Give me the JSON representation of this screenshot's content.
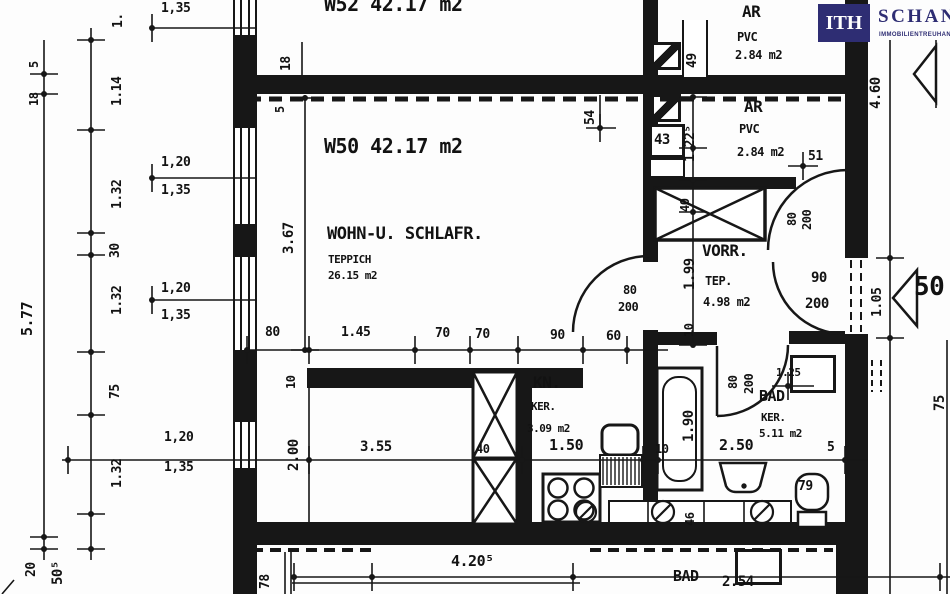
{
  "brand": {
    "logo_box": "ITH",
    "name": "SCHANTL",
    "tagline": "IMMOBILIENTREUHAND",
    "navy": "#2e2d73"
  },
  "plan_summary": {
    "apartments": [
      "W52 42.17 m2",
      "W50 42.17 m2"
    ],
    "rooms_w50": [
      {
        "name": "WOHN-U. SCHLAFR.",
        "floor": "TEPPICH",
        "area": "26.15 m2"
      },
      {
        "name": "VORR.",
        "floor": "TEP.",
        "area": "4.98 m2"
      },
      {
        "name": "KN.",
        "floor": "KER.",
        "area": "3.09 m2"
      },
      {
        "name": "BAD",
        "floor": "KER.",
        "area": "5.11 m2"
      },
      {
        "name": "AR",
        "floor": "PVC",
        "area": "2.84 m2"
      },
      {
        "name": "AR",
        "floor": "PVC",
        "area": "2.84 m2"
      }
    ]
  },
  "labels": [
    {
      "n": "w52-title",
      "t": "W52  42.17 m2",
      "x": 324,
      "y": -6,
      "fs": 20
    },
    {
      "n": "w50-title",
      "t": "W50  42.17 m2",
      "x": 324,
      "y": 136,
      "fs": 20
    },
    {
      "n": "w50-room-name",
      "t": "WOHN-U. SCHLAFR.",
      "x": 327,
      "y": 226,
      "fs": 17
    },
    {
      "n": "w50-floor",
      "t": "TEPPICH",
      "x": 328,
      "y": 254,
      "fs": 11
    },
    {
      "n": "w50-area",
      "t": "26.15 m2",
      "x": 328,
      "y": 270,
      "fs": 11
    },
    {
      "n": "ar1-name",
      "t": "AR",
      "x": 742,
      "y": 4,
      "fs": 16
    },
    {
      "n": "ar1-floor",
      "t": "PVC",
      "x": 737,
      "y": 31,
      "fs": 12
    },
    {
      "n": "ar1-area",
      "t": "2.84 m2",
      "x": 735,
      "y": 49,
      "fs": 12
    },
    {
      "n": "ar2-name",
      "t": "AR",
      "x": 744,
      "y": 99,
      "fs": 16
    },
    {
      "n": "ar2-floor",
      "t": "PVC",
      "x": 739,
      "y": 123,
      "fs": 12
    },
    {
      "n": "ar2-area",
      "t": "2.84 m2",
      "x": 737,
      "y": 146,
      "fs": 12
    },
    {
      "n": "vorr-name",
      "t": "VORR.",
      "x": 702,
      "y": 243,
      "fs": 16
    },
    {
      "n": "vorr-floor",
      "t": "TEP.",
      "x": 705,
      "y": 275,
      "fs": 12
    },
    {
      "n": "vorr-area",
      "t": "4.98 m2",
      "x": 703,
      "y": 296,
      "fs": 12
    },
    {
      "n": "kn-name",
      "t": "KN.",
      "x": 533,
      "y": 375,
      "fs": 16
    },
    {
      "n": "kn-floor",
      "t": "KER.",
      "x": 531,
      "y": 401,
      "fs": 11
    },
    {
      "n": "kn-area",
      "t": "3.09 m2",
      "x": 527,
      "y": 423,
      "fs": 11
    },
    {
      "n": "bad-name",
      "t": "BAD",
      "x": 759,
      "y": 389,
      "fs": 15
    },
    {
      "n": "bad-floor",
      "t": "KER.",
      "x": 761,
      "y": 412,
      "fs": 11
    },
    {
      "n": "bad-area",
      "t": "5.11 m2",
      "x": 759,
      "y": 428,
      "fs": 11
    },
    {
      "n": "nb-bad-name",
      "t": "BAD",
      "x": 673,
      "y": 569,
      "fs": 15
    },
    {
      "n": "nb-bad-dim",
      "t": "2.54",
      "x": 722,
      "y": 575,
      "fs": 14
    },
    {
      "n": "dim-80",
      "t": "80",
      "x": 265,
      "y": 326,
      "fs": 13
    },
    {
      "n": "dim-145",
      "t": "1.45",
      "x": 341,
      "y": 326,
      "fs": 13
    },
    {
      "n": "dim-70a",
      "t": "70",
      "x": 435,
      "y": 327,
      "fs": 13
    },
    {
      "n": "dim-70b",
      "t": "70",
      "x": 475,
      "y": 328,
      "fs": 13
    },
    {
      "n": "dim-90",
      "t": "90",
      "x": 550,
      "y": 329,
      "fs": 13
    },
    {
      "n": "dim-60",
      "t": "60",
      "x": 606,
      "y": 330,
      "fs": 13
    },
    {
      "n": "door-w50-w",
      "t": "80",
      "x": 623,
      "y": 284,
      "fs": 12
    },
    {
      "n": "door-w50-h",
      "t": "200",
      "x": 618,
      "y": 301,
      "fs": 12
    },
    {
      "n": "dim-355",
      "t": "3.55",
      "x": 360,
      "y": 440,
      "fs": 14
    },
    {
      "n": "dim-40",
      "t": "40",
      "x": 476,
      "y": 443,
      "fs": 12
    },
    {
      "n": "dim-150",
      "t": "1.50",
      "x": 549,
      "y": 438,
      "fs": 15
    },
    {
      "n": "dim-10a",
      "t": "10",
      "x": 655,
      "y": 443,
      "fs": 12
    },
    {
      "n": "dim-250",
      "t": "2.50",
      "x": 719,
      "y": 438,
      "fs": 15
    },
    {
      "n": "dim-5a",
      "t": "5",
      "x": 827,
      "y": 441,
      "fs": 13
    },
    {
      "n": "door-entr-w",
      "t": "90",
      "x": 811,
      "y": 271,
      "fs": 14
    },
    {
      "n": "door-entr-h",
      "t": "200",
      "x": 805,
      "y": 297,
      "fs": 14
    },
    {
      "n": "dim-4205",
      "t": "4.20⁵",
      "x": 451,
      "y": 554,
      "fs": 15
    },
    {
      "n": "dim-43",
      "t": "43",
      "x": 654,
      "y": 133,
      "fs": 14
    },
    {
      "n": "dim-51",
      "t": "51",
      "x": 808,
      "y": 150,
      "fs": 13
    },
    {
      "n": "wc-79",
      "t": "79",
      "x": 798,
      "y": 480,
      "fs": 13
    },
    {
      "n": "dim-125",
      "t": "1.25",
      "x": 776,
      "y": 367,
      "fs": 11
    },
    {
      "n": "marker-50",
      "t": "50",
      "x": 914,
      "y": 274,
      "fs": 26
    },
    {
      "n": "win-135a",
      "t": "1,35",
      "x": 161,
      "y": 2,
      "fs": 13
    },
    {
      "n": "win-120a",
      "t": "1,20",
      "x": 161,
      "y": 156,
      "fs": 13
    },
    {
      "n": "win-135b",
      "t": "1,35",
      "x": 161,
      "y": 184,
      "fs": 13
    },
    {
      "n": "win-120b",
      "t": "1,20",
      "x": 161,
      "y": 282,
      "fs": 13
    },
    {
      "n": "win-135c",
      "t": "1,35",
      "x": 161,
      "y": 309,
      "fs": 13
    },
    {
      "n": "win-120c",
      "t": "1,20",
      "x": 164,
      "y": 431,
      "fs": 13
    },
    {
      "n": "win-135d",
      "t": "1,35",
      "x": 164,
      "y": 461,
      "fs": 13
    },
    {
      "n": "dim-577",
      "t": "5.77",
      "x": 20,
      "y": 336,
      "fs": 15,
      "r": 1
    },
    {
      "n": "dim-out5",
      "t": "5",
      "x": 28,
      "y": 68,
      "fs": 12,
      "r": 1
    },
    {
      "n": "dim-out18",
      "t": "18",
      "x": 28,
      "y": 106,
      "fs": 12,
      "r": 1
    },
    {
      "n": "dim-top-part",
      "t": "1.",
      "x": 112,
      "y": 28,
      "fs": 13,
      "r": 1
    },
    {
      "n": "dim-114",
      "t": "1.14",
      "x": 111,
      "y": 106,
      "fs": 13,
      "r": 1
    },
    {
      "n": "dim-132a",
      "t": "1.32",
      "x": 111,
      "y": 209,
      "fs": 13,
      "r": 1
    },
    {
      "n": "dim-30",
      "t": "30",
      "x": 109,
      "y": 258,
      "fs": 13,
      "r": 1
    },
    {
      "n": "dim-132b",
      "t": "1.32",
      "x": 111,
      "y": 315,
      "fs": 13,
      "r": 1
    },
    {
      "n": "dim-75",
      "t": "75",
      "x": 109,
      "y": 399,
      "fs": 13,
      "r": 1
    },
    {
      "n": "dim-132c",
      "t": "1.32",
      "x": 111,
      "y": 488,
      "fs": 13,
      "r": 1
    },
    {
      "n": "dim-20",
      "t": "20",
      "x": 25,
      "y": 577,
      "fs": 13,
      "r": 1
    },
    {
      "n": "dim-505",
      "t": "50⁵",
      "x": 51,
      "y": 585,
      "fs": 14,
      "r": 1
    },
    {
      "n": "dim-int18",
      "t": "18",
      "x": 280,
      "y": 71,
      "fs": 13,
      "r": 1
    },
    {
      "n": "dim-int5",
      "t": "5",
      "x": 274,
      "y": 113,
      "fs": 12,
      "r": 1
    },
    {
      "n": "dim-367",
      "t": "3.67",
      "x": 282,
      "y": 254,
      "fs": 14,
      "r": 1
    },
    {
      "n": "dim-10b",
      "t": "10",
      "x": 285,
      "y": 389,
      "fs": 12,
      "r": 1
    },
    {
      "n": "dim-200v",
      "t": "2.00",
      "x": 287,
      "y": 471,
      "fs": 14,
      "r": 1
    },
    {
      "n": "dim-49",
      "t": "49",
      "x": 686,
      "y": 68,
      "fs": 13,
      "r": 1
    },
    {
      "n": "dim-1225",
      "t": "1.22⁵",
      "x": 684,
      "y": 162,
      "fs": 13,
      "r": 1
    },
    {
      "n": "dim-54",
      "t": "54",
      "x": 584,
      "y": 125,
      "fs": 13,
      "r": 1
    },
    {
      "n": "dim-40w",
      "t": "40",
      "x": 679,
      "y": 212,
      "fs": 12,
      "r": 1
    },
    {
      "n": "dim-199",
      "t": "1.99",
      "x": 683,
      "y": 290,
      "fs": 14,
      "r": 1
    },
    {
      "n": "dim-10c",
      "t": "10",
      "x": 683,
      "y": 337,
      "fs": 12,
      "r": 1
    },
    {
      "n": "door-ar2-w",
      "t": "80",
      "x": 786,
      "y": 226,
      "fs": 12,
      "r": 1
    },
    {
      "n": "door-ar2-h",
      "t": "200",
      "x": 801,
      "y": 230,
      "fs": 12,
      "r": 1
    },
    {
      "n": "door-bad-w",
      "t": "80",
      "x": 727,
      "y": 389,
      "fs": 12,
      "r": 1
    },
    {
      "n": "door-bad-h",
      "t": "200",
      "x": 743,
      "y": 394,
      "fs": 12,
      "r": 1
    },
    {
      "n": "dim-190",
      "t": "1.90",
      "x": 682,
      "y": 442,
      "fs": 14,
      "r": 1
    },
    {
      "n": "dim-46",
      "t": "46",
      "x": 684,
      "y": 526,
      "fs": 12,
      "r": 1
    },
    {
      "n": "dim-460",
      "t": "4.60",
      "x": 869,
      "y": 109,
      "fs": 14,
      "r": 1
    },
    {
      "n": "dim-105",
      "t": "1.05",
      "x": 871,
      "y": 317,
      "fs": 13,
      "r": 1
    },
    {
      "n": "dim-75r",
      "t": "75",
      "x": 933,
      "y": 411,
      "fs": 14,
      "r": 1
    },
    {
      "n": "dim-78",
      "t": "78",
      "x": 259,
      "y": 589,
      "fs": 13,
      "r": 1
    }
  ]
}
